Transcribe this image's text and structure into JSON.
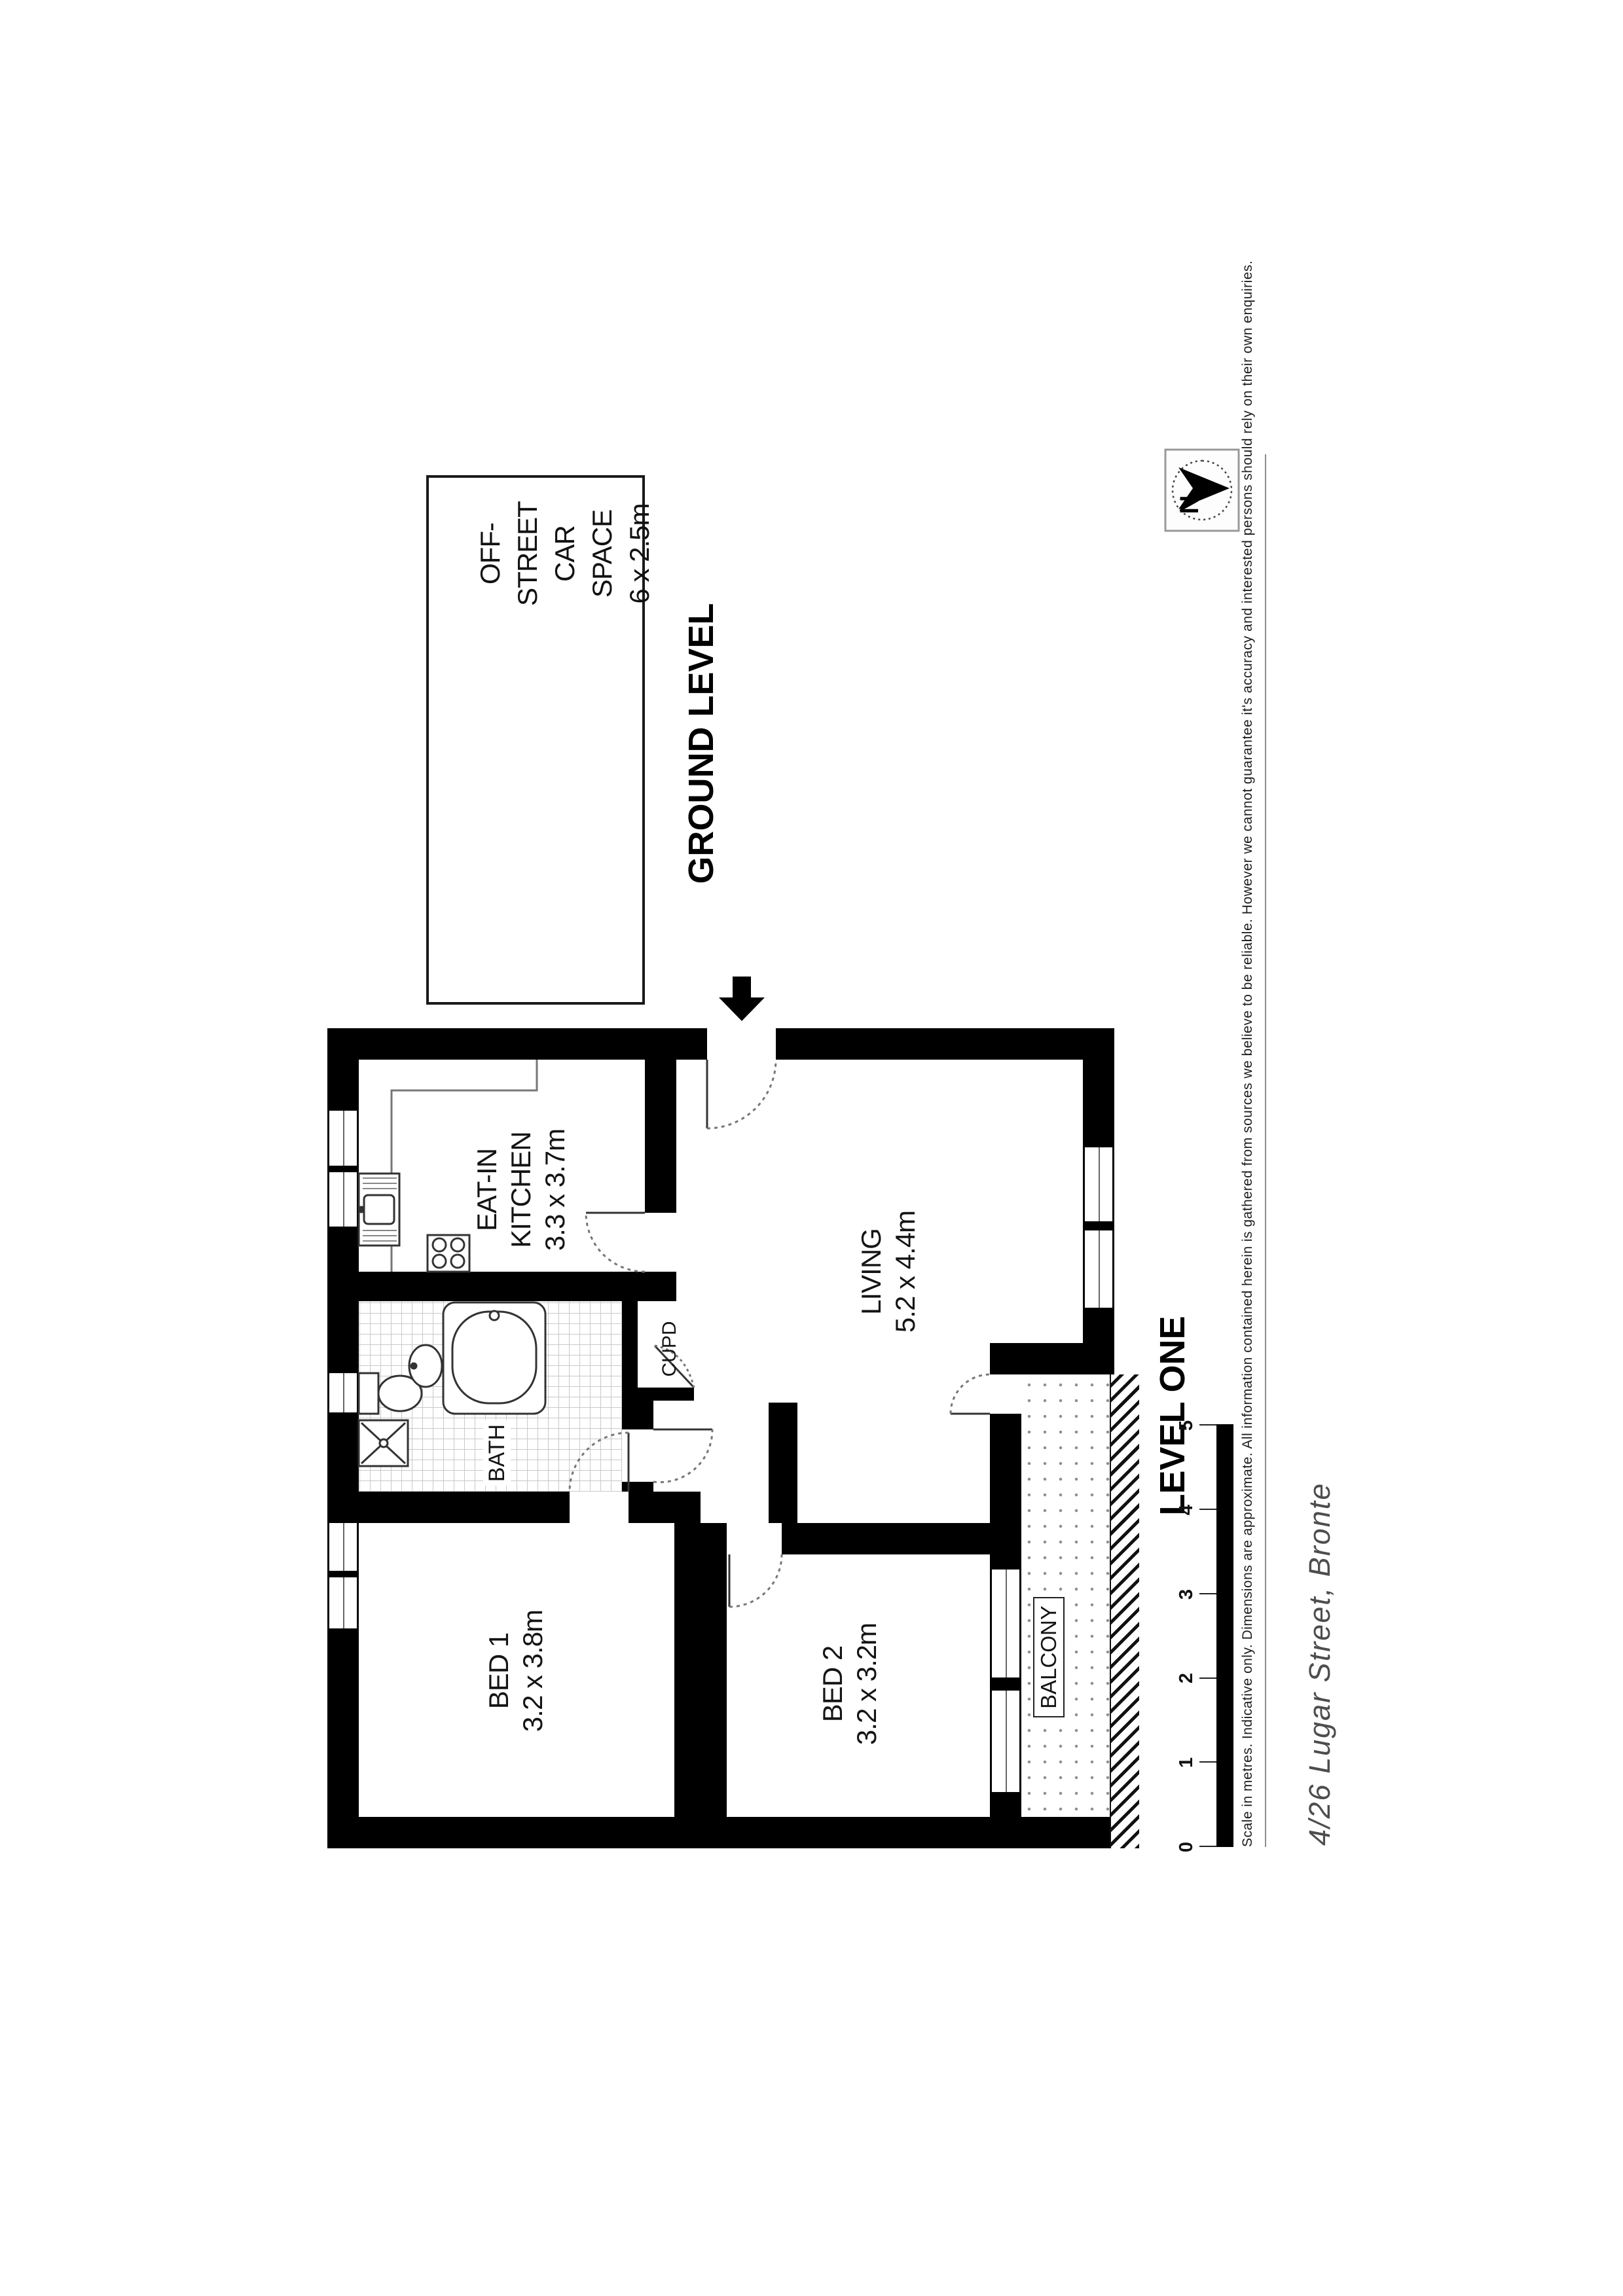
{
  "car_space": {
    "line1": "OFF-STREET",
    "line2": "CAR SPACE",
    "line3": "6 x 2.5m"
  },
  "levels": {
    "ground": "GROUND LEVEL",
    "one": "LEVEL ONE"
  },
  "north": {
    "label": "N"
  },
  "rooms": {
    "kitchen": {
      "line1": "EAT-IN",
      "line2": "KITCHEN",
      "dims": "3.3 x 3.7m"
    },
    "living": {
      "name": "LIVING",
      "dims": "5.2 x 4.4m"
    },
    "bed1": {
      "name": "BED 1",
      "dims": "3.2 x 3.8m"
    },
    "bed2": {
      "name": "BED 2",
      "dims": "3.2 x 3.2m"
    },
    "bath": {
      "name": "BATH"
    },
    "cupboard": {
      "name": "CUPD"
    },
    "balcony": {
      "name": "BALCONY"
    }
  },
  "scale_bar": {
    "labels": [
      "0",
      "1",
      "2",
      "3",
      "4",
      "5"
    ]
  },
  "disclaimer": "Scale in metres. Indicative only. Dimensions are approximate. All information contained herein is gathered from sources we believe to be reliable. However we cannot guarantee it's accuracy and interested persons should rely on their own enquiries.",
  "address": "4/26 Lugar Street, Bronte",
  "colors": {
    "wall": "#000000",
    "accent": "#000000",
    "address_text": "#4d4d4d",
    "tile_line": "#c9c9c9"
  }
}
